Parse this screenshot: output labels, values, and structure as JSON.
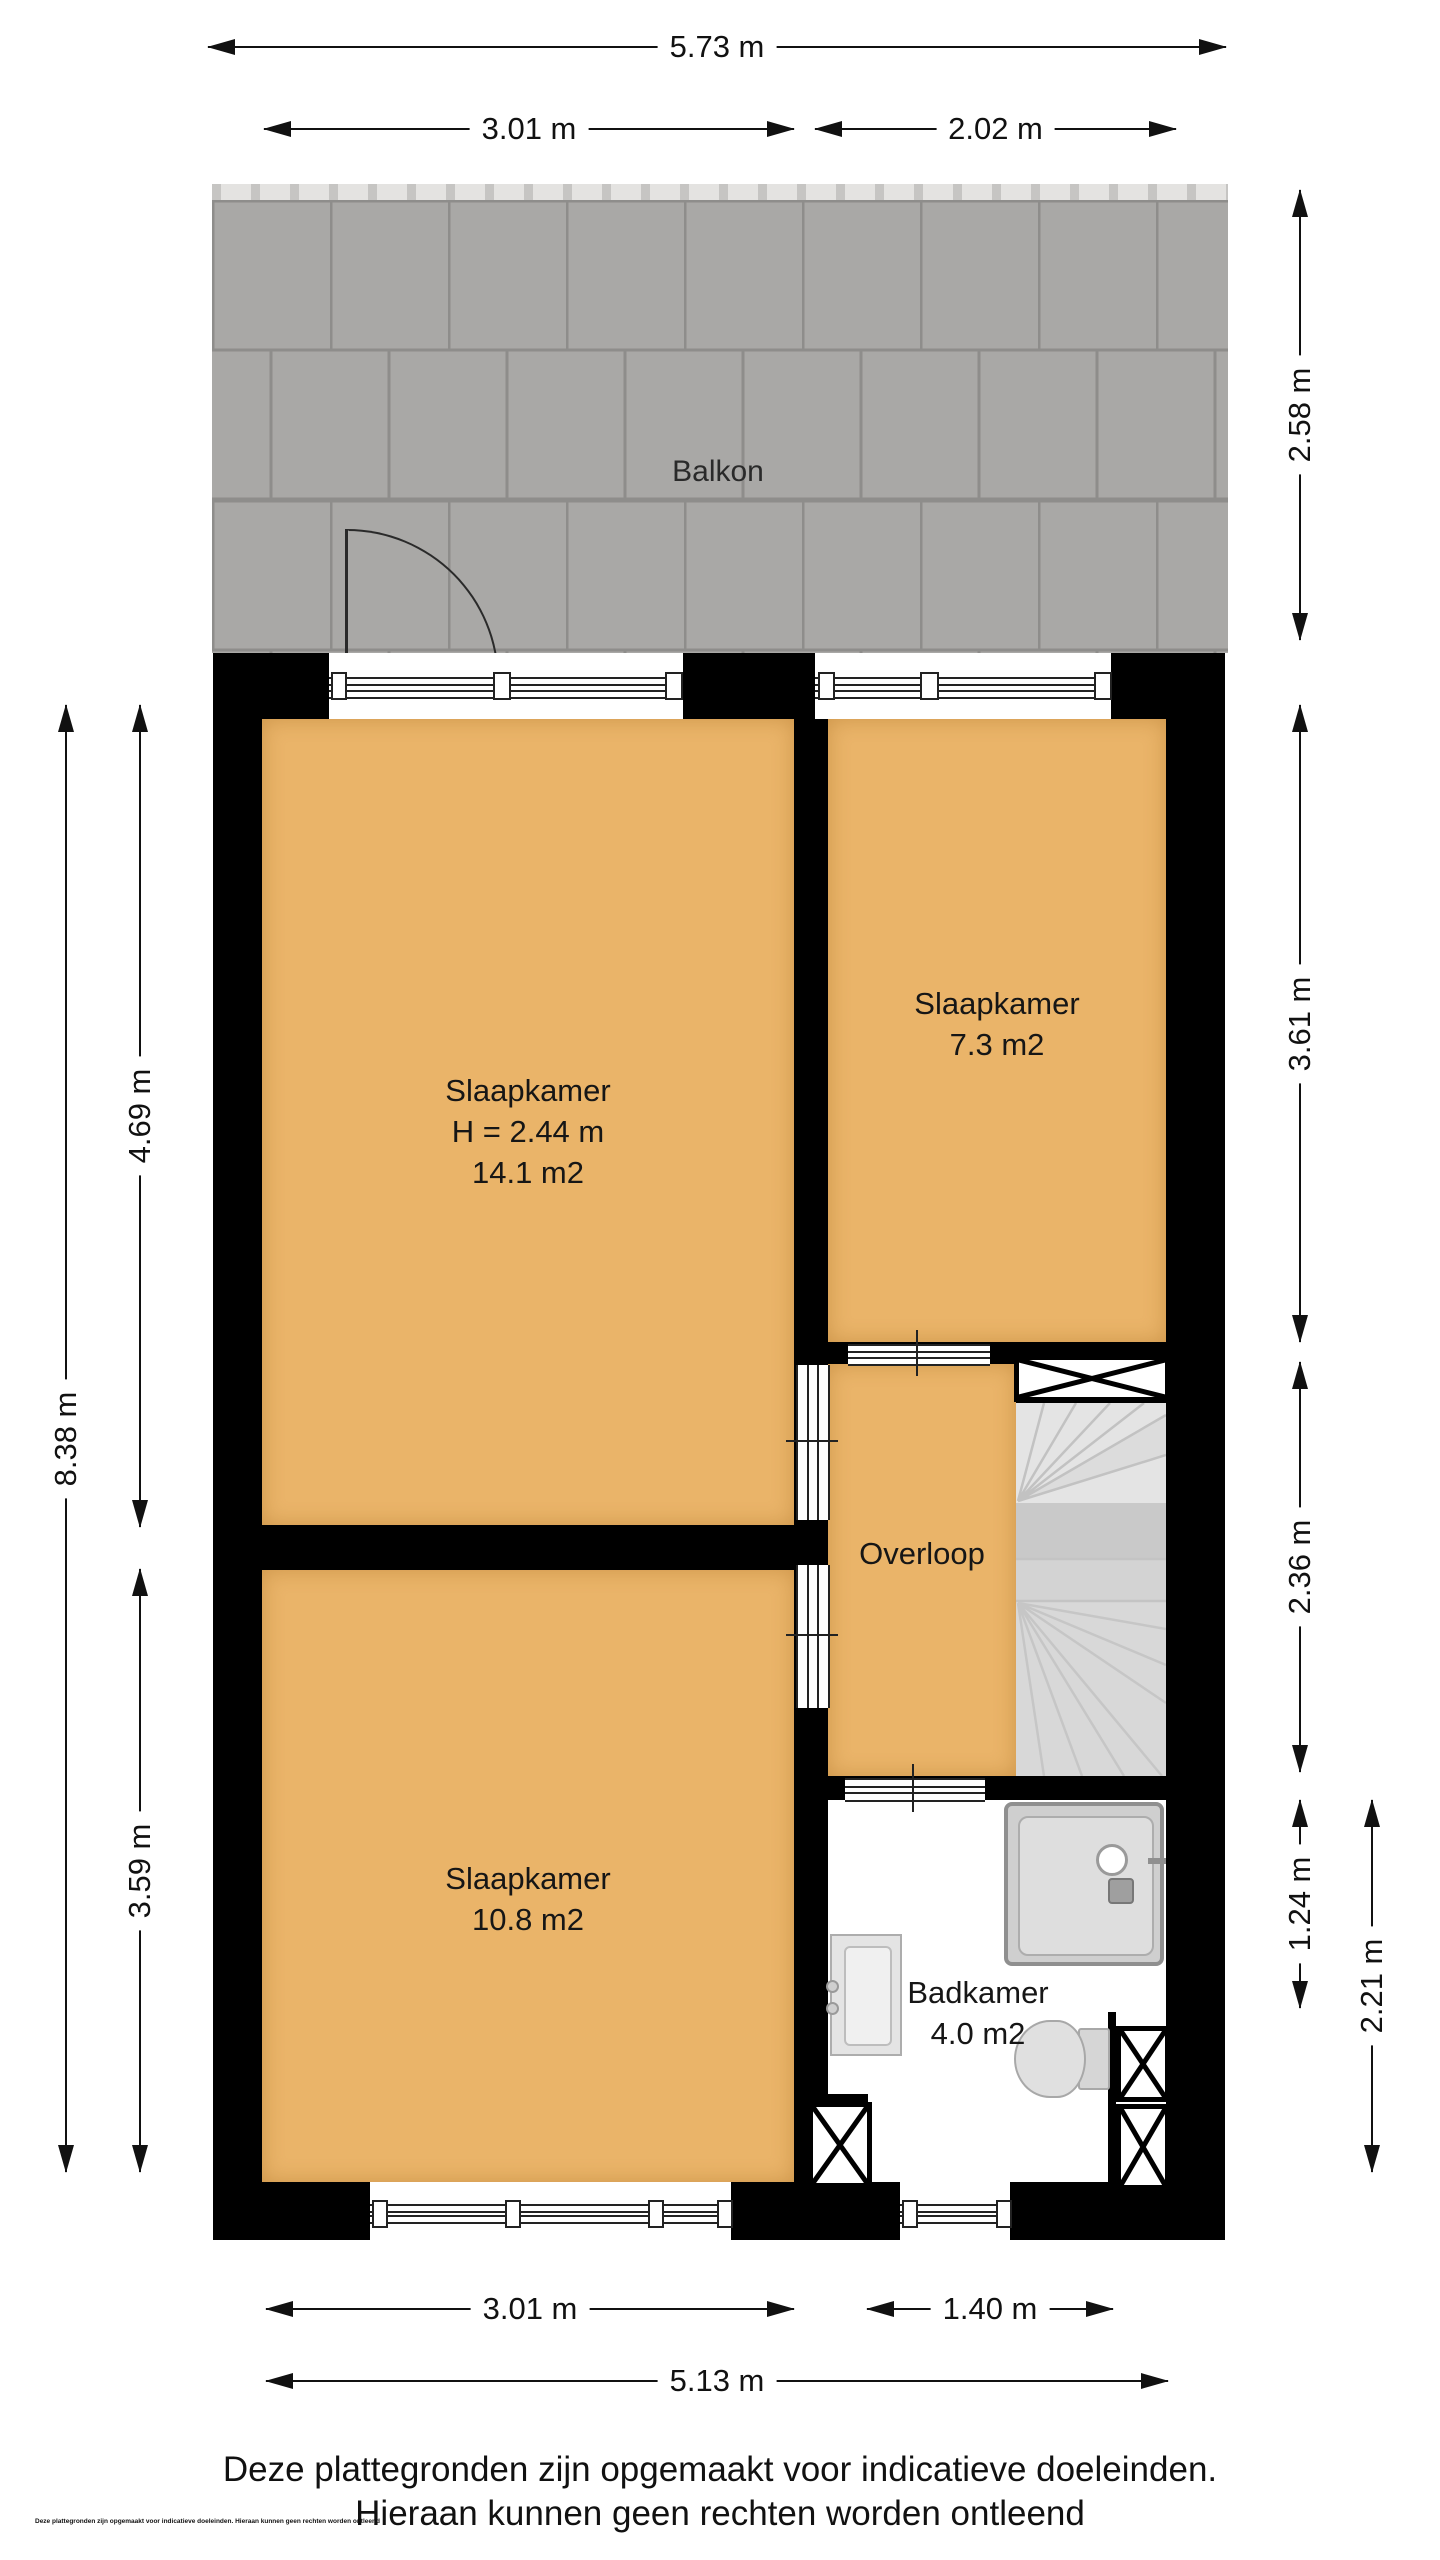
{
  "plan": {
    "balcony_label": "Balkon",
    "rooms": {
      "slaapkamer_groot": {
        "name": "Slaapkamer",
        "height": "H = 2.44 m",
        "area": "14.1 m2"
      },
      "slaapkamer_klein": {
        "name": "Slaapkamer",
        "area": "7.3 m2"
      },
      "slaapkamer_onder": {
        "name": "Slaapkamer",
        "area": "10.8 m2"
      },
      "overloop": {
        "name": "Overloop"
      },
      "badkamer": {
        "name": "Badkamer",
        "area": "4.0 m2"
      }
    }
  },
  "dimensions": {
    "top_total": "5.73 m",
    "top_left": "3.01 m",
    "top_right": "2.02 m",
    "balcony_depth": "2.58 m",
    "left_total": "8.38 m",
    "left_upper": "4.69 m",
    "left_lower": "3.59 m",
    "right_upper": "3.61 m",
    "right_middle": "2.36 m",
    "right_small": "1.24 m",
    "right_lower": "2.21 m",
    "bottom_left": "3.01 m",
    "bottom_right": "1.40 m",
    "bottom_total": "5.13 m"
  },
  "footer": {
    "line1": "Deze plattegronden zijn opgemaakt voor indicatieve doeleinden.",
    "line2": "Hieraan kunnen geen rechten worden ontleend"
  },
  "fine_print": "Deze plattegronden zijn opgemaakt voor indicatieve doeleinden. Hieraan kunnen geen rechten worden ontleend",
  "colors": {
    "floor": "#eab469",
    "wall": "#000000",
    "balcony_tile": "#a9a8a6",
    "balcony_grout": "#8e8d8b",
    "stairs": "#d8d8d8",
    "text": "#1b1b1b"
  }
}
